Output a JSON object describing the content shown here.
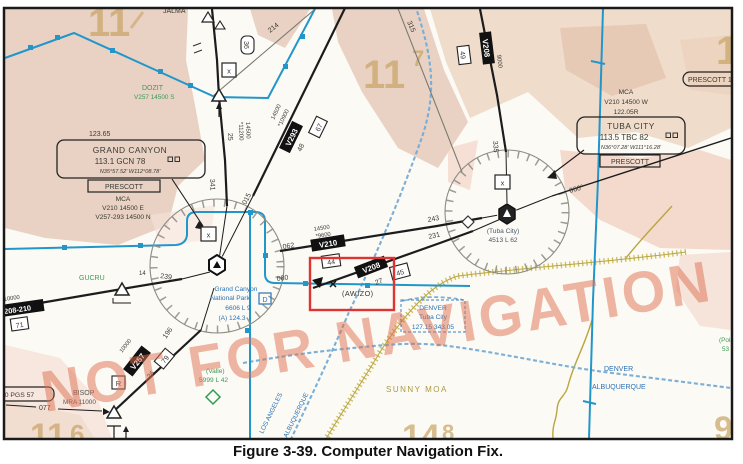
{
  "caption": "Figure 3-39. Computer Navigation Fix.",
  "watermark": "NOT FOR NAVIGATION",
  "grid": {
    "tl": "11",
    "center": "11",
    "center_sup": "7",
    "tr": "1",
    "bl": "11",
    "bl_sup": "6",
    "bc": "14",
    "bc_sup": "8",
    "br": "9"
  },
  "grand_canyon": {
    "freq": "123.65",
    "name": "GRAND CANYON",
    "ident": "113.1 GCN 78",
    "coords": "N35°57.52' W112°08.78'",
    "artcc": "PRESCOTT",
    "mca1": "MCA",
    "mca2": "V210 14500 E",
    "mca3": "V257-293 14500 N",
    "airport1": "Grand Canyon",
    "airport2": "National Park",
    "airport3": "6606 L 9",
    "airport4": "(A) 124.3"
  },
  "tuba_city": {
    "mca1": "MCA",
    "mca2": "V210 14500 W",
    "mca3": "122.05R",
    "name": "TUBA CITY",
    "ident": "113.5 TBC 82",
    "coords": "N36°07.28' W111°16.28'",
    "artcc": "PRESCOTT",
    "airport1": "(Tuba City)",
    "airport2": "4513 L 62"
  },
  "fixes": {
    "jalma": "JALMA",
    "dozit": "DOZIT",
    "dozit_note": "V257 14500 S",
    "gucru": "GUCRU",
    "bisop": "BISOP",
    "bisop_note": "MRA 11000",
    "awizo": "(AWIZO)",
    "valle": "(Valle)",
    "valle_note": "5999 L 42",
    "polacca": "(Pola",
    "polacca_note": "53"
  },
  "airways": {
    "v210": "V210",
    "v208": "V208",
    "v293": "V293",
    "v257": "V257",
    "v208_210": "V208-210"
  },
  "distances": {
    "d14": "14",
    "d25": "25",
    "d26": "26",
    "d27": "27",
    "d36": "36",
    "d44": "44",
    "d45": "45",
    "d48": "48",
    "d49": "49",
    "d67": "67",
    "d71": "71",
    "d79": "79"
  },
  "altitudes": {
    "a14500_1": "14500",
    "a11200": "*11200",
    "a14500_2": "14500",
    "a10900": "*10900",
    "a14500_3": "14500",
    "a9600": "*9600",
    "a9000": "9000",
    "a10000_1": "10000",
    "a10000_2": "10000"
  },
  "radials": {
    "r015": "015",
    "r060": "060°",
    "r062": "062",
    "r077": "077",
    "r080": "080",
    "r196": "196",
    "r214": "214",
    "r231": "231",
    "r239": "239",
    "r243": "243",
    "r315": "315",
    "r335": "335",
    "r341": "341"
  },
  "boundaries": {
    "los_angeles": "LOS ANGELES",
    "albuquerque_w": "ALBUQUERQUE",
    "denver": "DENVER",
    "albuquerque_e": "ALBUQUERQUE"
  },
  "rco": {
    "name": "DENVER",
    "station": "Tuba City",
    "freqs": "127.15 343.05"
  },
  "moa": {
    "name": "SUNNY MOA"
  },
  "misc": {
    "prescott_partial": "PRESCOTT 1",
    "x_marker": "x",
    "d_symbol": "D",
    "pgs": "112.0 PGS 57"
  }
}
